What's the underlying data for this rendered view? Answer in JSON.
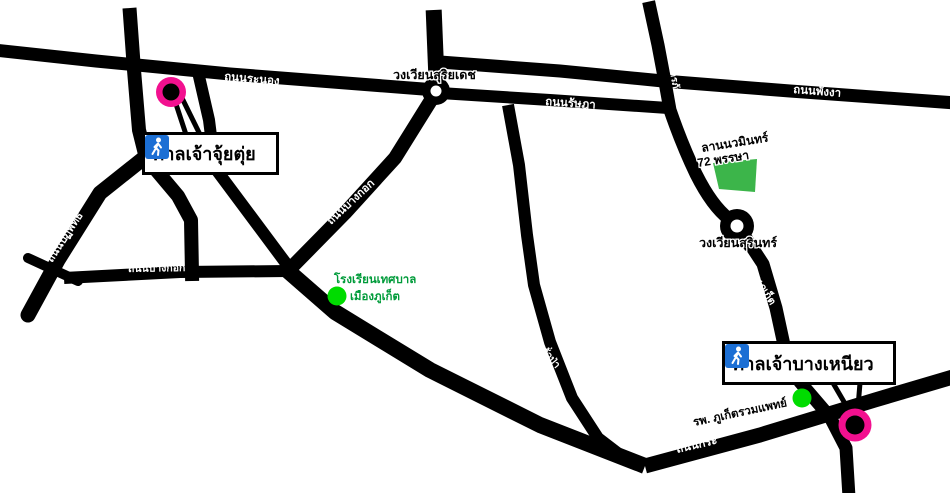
{
  "map": {
    "colors": {
      "road": "#000000",
      "background": "#ffffff",
      "marker_pink": "#f2108f",
      "marker_center": "#000000",
      "park_green": "#3cb54a",
      "dot_green": "#00dc00",
      "green_text": "#009b3a",
      "icon_blue": "#1c6fd4"
    },
    "roads": {
      "ranong": "ถนนระนอง",
      "rassada": "ถนนรัษฎา",
      "phangnga": "ถนนพังงา",
      "komarapat": "ถนนโกมารภัจจ์",
      "phuket": "ถนนภูเก็ต",
      "bangkok_horizontal": "ถนนบางกอก",
      "bangkok_diagonal": "ถนนบางกอก",
      "patiphat": "ถนนปฏิพัทธ์",
      "phutorn": "ถนนภูธร",
      "phunphon": "ถนนพูนผล",
      "takuapa": "ถนนตะกั่วป่า",
      "kra": "ถนนกระ"
    },
    "roundabouts": {
      "suriyadet": "วงเวียนสุริยเดช",
      "surin": "วงเวียนสุรินทร์"
    },
    "places": {
      "jui_tui_shrine": "ศาลเจ้าจุ้ยตุ่ย",
      "bang_neow_shrine": "ศาลเจ้าบางเหนียว",
      "park_line1": "ลานนวมินทร์",
      "park_line2": "72 พรรษา",
      "school_line1": "โรงเรียนเทศบาล",
      "school_line2": "เมืองภูเก็ต",
      "hospital": "รพ. ภูเก็ตรวมแพทย์"
    }
  }
}
